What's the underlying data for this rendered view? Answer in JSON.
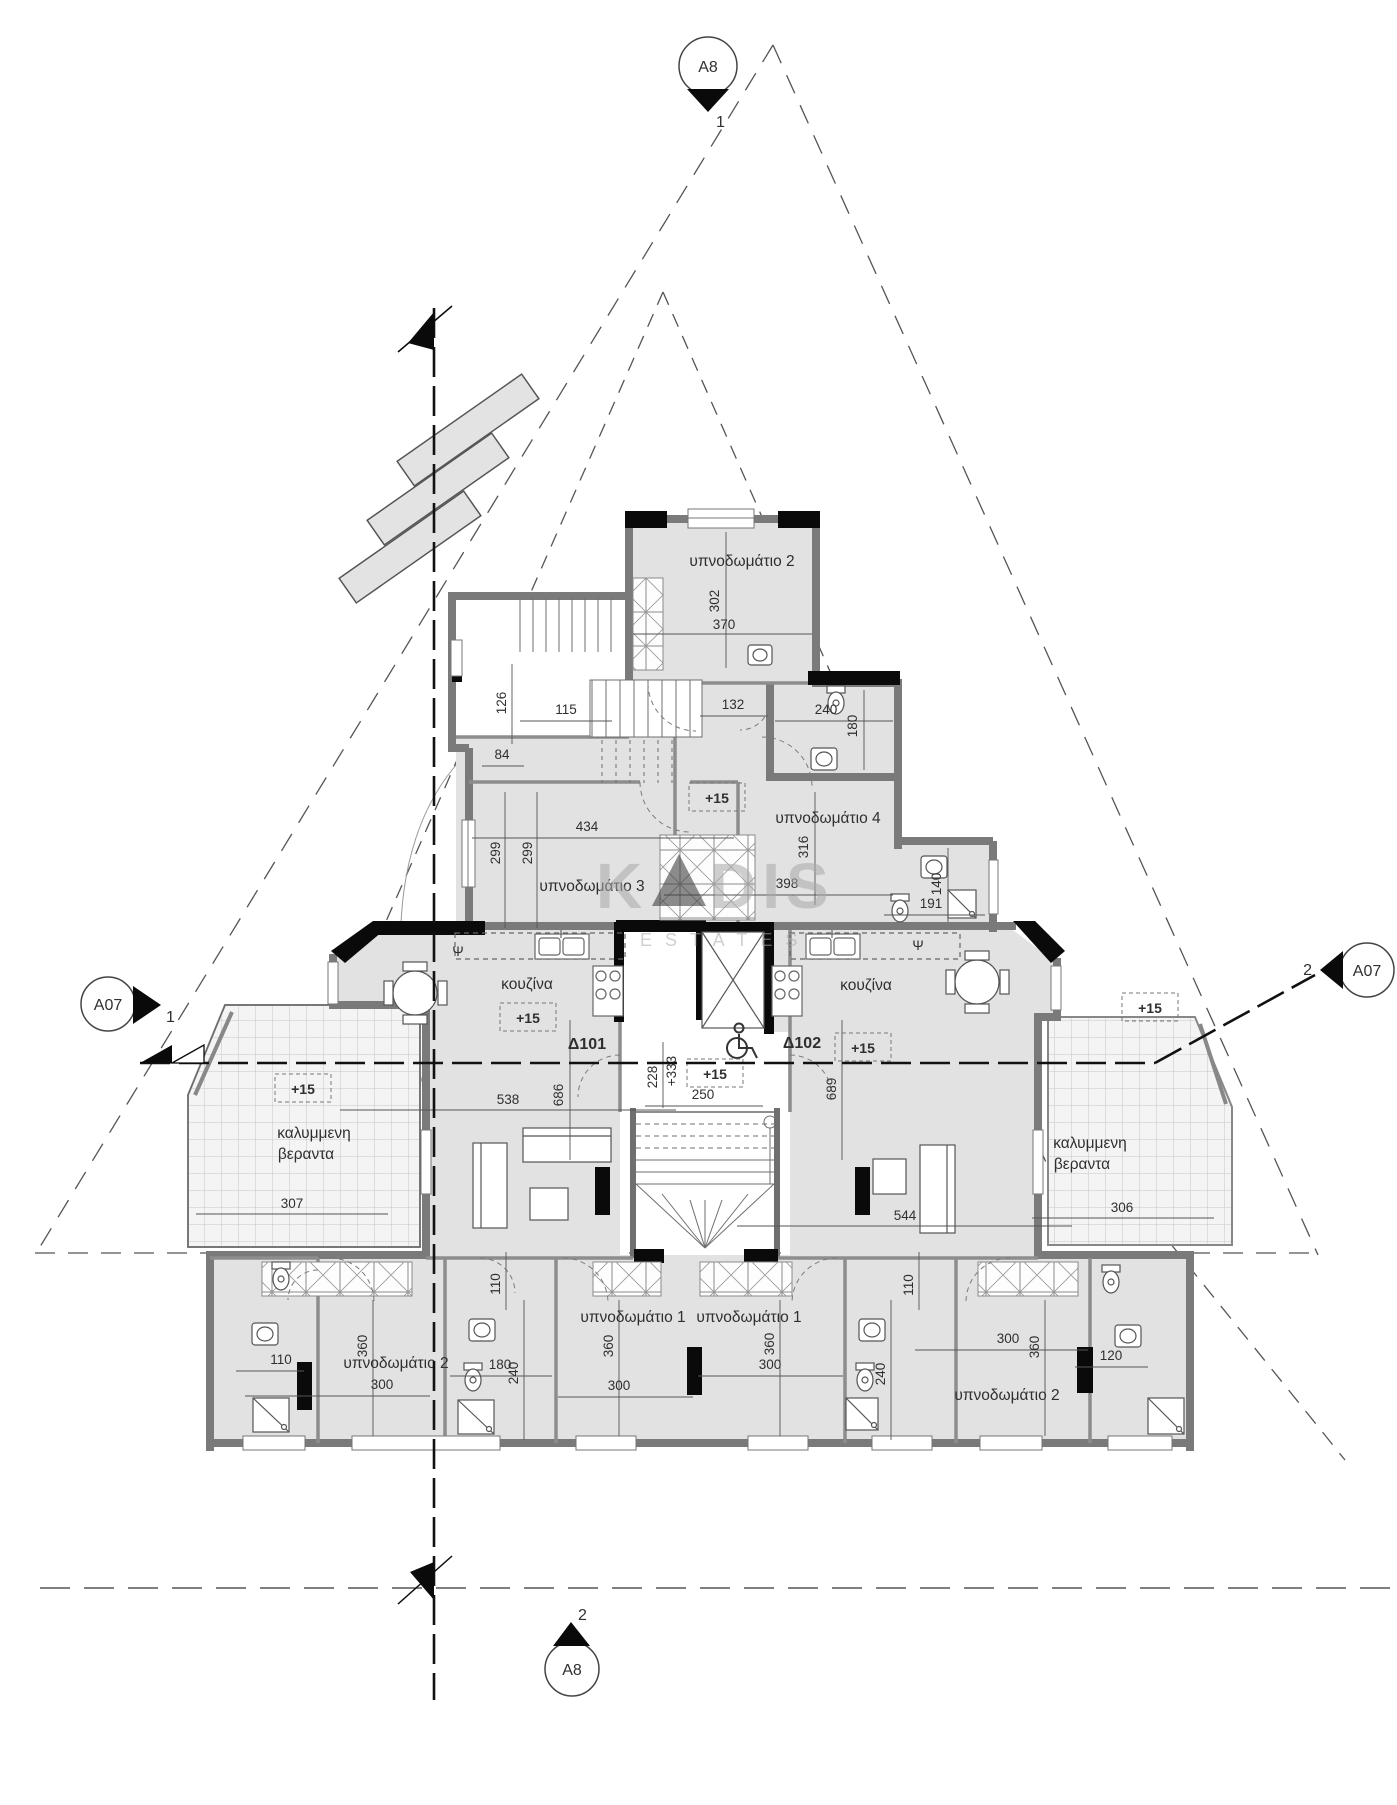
{
  "markers": {
    "top": {
      "label": "A8",
      "number": "1"
    },
    "left": {
      "label": "A07",
      "number": "1"
    },
    "right": {
      "label": "A07",
      "number": "2"
    },
    "bottom": {
      "label": "A8",
      "number": "2"
    }
  },
  "watermark": {
    "part1": "K",
    "part2": "DIS",
    "subtitle": "ESTATES"
  },
  "rooms": {
    "bedroom2_top": "υπνοδωμάτιο 2",
    "bedroom3": "υπνοδωμάτιο 3",
    "bedroom4": "υπνοδωμάτιο 4",
    "kitchen_left": "κουζίνα",
    "kitchen_right": "κουζίνα",
    "veranda_line1": "καλυμμενη",
    "veranda_line2": "βεραντα",
    "bedroom1_left": "υπνοδωμάτιο 1",
    "bedroom1_right": "υπνοδωμάτιο 1",
    "bedroom2_bottom_left": "υπνοδωμάτιο 2",
    "bedroom2_bottom_right": "υπνοδωμάτιο 2"
  },
  "apartments": {
    "left": "Δ101",
    "right": "Δ102"
  },
  "levels": {
    "floor": "+15",
    "stair": "+333"
  },
  "symbols": {
    "fridge": "Ψ"
  },
  "dims": [
    {
      "t": "302"
    },
    {
      "t": "370"
    },
    {
      "t": "126"
    },
    {
      "t": "115"
    },
    {
      "t": "84"
    },
    {
      "t": "132"
    },
    {
      "t": "240"
    },
    {
      "t": "180"
    },
    {
      "t": "434"
    },
    {
      "t": "299"
    },
    {
      "t": "299"
    },
    {
      "t": "316"
    },
    {
      "t": "398"
    },
    {
      "t": "140"
    },
    {
      "t": "191"
    },
    {
      "t": "228"
    },
    {
      "t": "250"
    },
    {
      "t": "689"
    },
    {
      "t": "686"
    },
    {
      "t": "538"
    },
    {
      "t": "544"
    },
    {
      "t": "307"
    },
    {
      "t": "306"
    },
    {
      "t": "110"
    },
    {
      "t": "110"
    },
    {
      "t": "110"
    },
    {
      "t": "360"
    },
    {
      "t": "300"
    },
    {
      "t": "180"
    },
    {
      "t": "240"
    },
    {
      "t": "360"
    },
    {
      "t": "300"
    },
    {
      "t": "360"
    },
    {
      "t": "300"
    },
    {
      "t": "300"
    },
    {
      "t": "360"
    },
    {
      "t": "120"
    },
    {
      "t": "240"
    }
  ]
}
